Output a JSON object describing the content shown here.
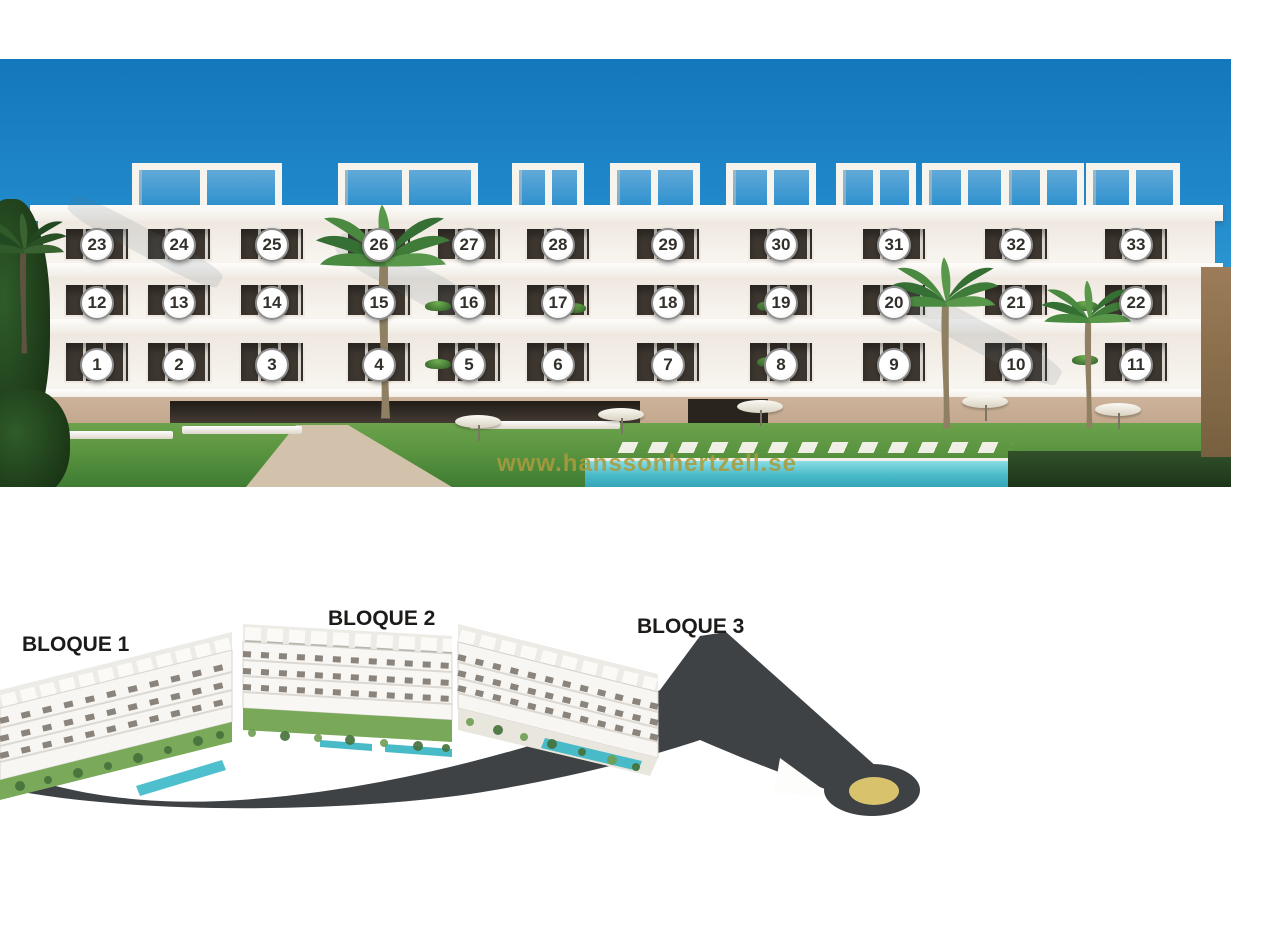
{
  "watermark": {
    "text": "www.hanssonhertzell.se",
    "color": "#a89b3e"
  },
  "top_render": {
    "title": "facade-render-with-unit-numbers",
    "sky_colors": {
      "top": "#1477bc",
      "bottom": "#8ccbe9"
    },
    "badge_style": {
      "fill": "#ffffff",
      "border": "#8d8d8d",
      "text_color": "#33302b"
    },
    "columns_x": [
      97,
      179,
      272,
      379,
      469,
      558,
      668,
      781,
      894,
      1016,
      1136
    ],
    "rows": [
      {
        "floor": "penthouse",
        "y": 245,
        "numbers": [
          "23",
          "24",
          "25",
          "26",
          "27",
          "28",
          "29",
          "30",
          "31",
          "32",
          "33"
        ]
      },
      {
        "floor": "first-floor",
        "y": 303,
        "numbers": [
          "12",
          "13",
          "14",
          "15",
          "16",
          "17",
          "18",
          "19",
          "20",
          "21",
          "22"
        ]
      },
      {
        "floor": "ground-floor",
        "y": 365,
        "numbers": [
          "1",
          "2",
          "3",
          "4",
          "5",
          "6",
          "7",
          "8",
          "9",
          "10",
          "11"
        ]
      }
    ],
    "pergolas": [
      {
        "x": 132,
        "w": 150
      },
      {
        "x": 338,
        "w": 140
      },
      {
        "x": 512,
        "w": 72
      },
      {
        "x": 610,
        "w": 90
      },
      {
        "x": 726,
        "w": 90
      },
      {
        "x": 836,
        "w": 80
      },
      {
        "x": 922,
        "w": 86
      },
      {
        "x": 1002,
        "w": 82
      },
      {
        "x": 1086,
        "w": 94
      }
    ],
    "window_floors": [
      {
        "top": 168,
        "h": 34
      },
      {
        "top": 224,
        "h": 34
      },
      {
        "top": 282,
        "h": 42
      }
    ]
  },
  "bottom_render": {
    "title": "aerial-site-render-three-blocks",
    "blocks": [
      {
        "label": "BLOQUE 1",
        "x": 22,
        "y": 633
      },
      {
        "label": "BLOQUE 2",
        "x": 328,
        "y": 607
      },
      {
        "label": "BLOQUE 3",
        "x": 637,
        "y": 615
      }
    ],
    "road_color": "#3e4245",
    "roundabout_color": "#d8c26c"
  }
}
